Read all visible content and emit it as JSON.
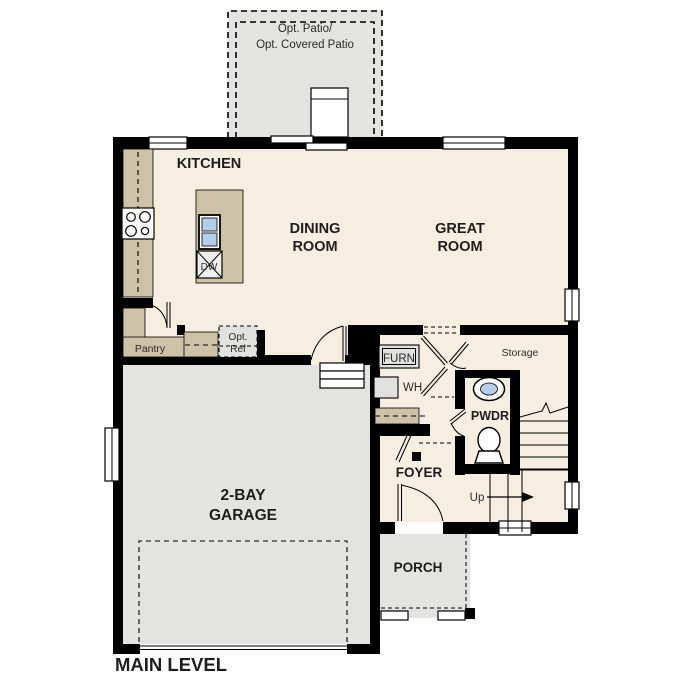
{
  "plan_title": "MAIN LEVEL",
  "patio": {
    "line1": "Opt. Patio/",
    "line2": "Opt. Covered Patio"
  },
  "rooms": {
    "kitchen": "KITCHEN",
    "dining_line1": "DINING",
    "dining_line2": "ROOM",
    "great_line1": "GREAT",
    "great_line2": "ROOM",
    "garage_line1": "2-BAY",
    "garage_line2": "GARAGE",
    "foyer": "FOYER",
    "porch": "PORCH",
    "pwdr": "PWDR",
    "storage": "Storage",
    "pantry": "Pantry"
  },
  "fixtures": {
    "furnace": "FURN",
    "water_heater": "WH",
    "dishwasher": "DW",
    "opt_ref_line1": "Opt.",
    "opt_ref_line2": "Ref",
    "stairs_up": "Up"
  },
  "colors": {
    "wall": "#000000",
    "floor": "#f6eee0",
    "garage": "#e3e3e1",
    "counter": "#cdc1a8",
    "fixture_gray": "#e1e1e0",
    "sink_blue": "#b5cde9",
    "background": "#ffffff"
  }
}
